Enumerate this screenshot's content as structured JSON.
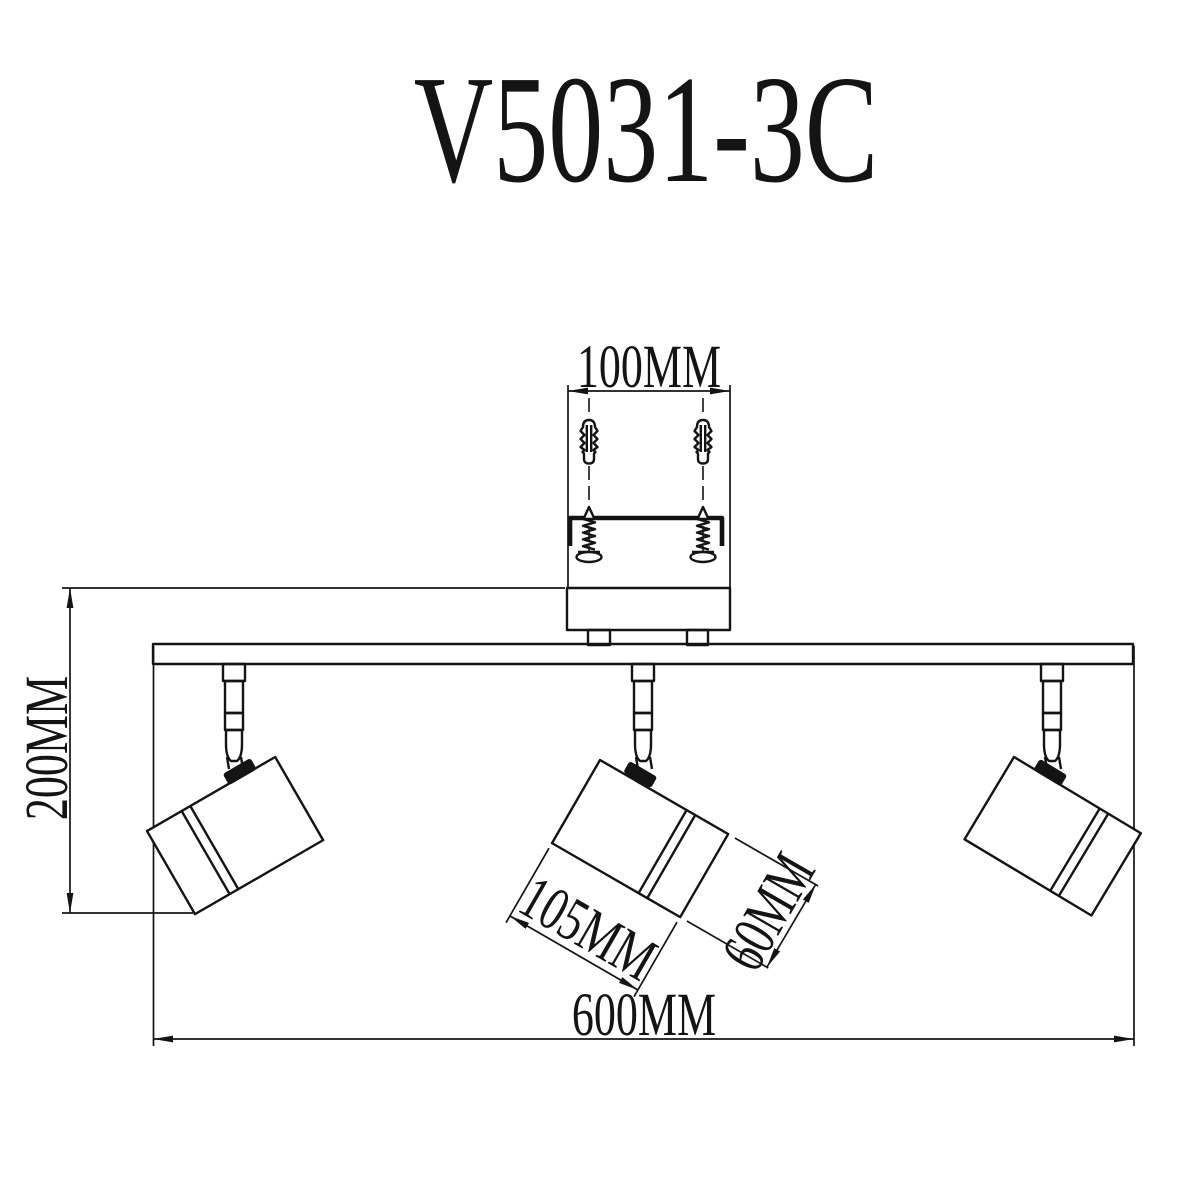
{
  "title": "V5031-3C",
  "labels": {
    "hole_spacing": "100MM",
    "height": "200MM",
    "head_length": "105MM",
    "head_diameter": "60MM",
    "width": "600MM"
  },
  "colors": {
    "ink": "#141414",
    "background": "#ffffff"
  }
}
